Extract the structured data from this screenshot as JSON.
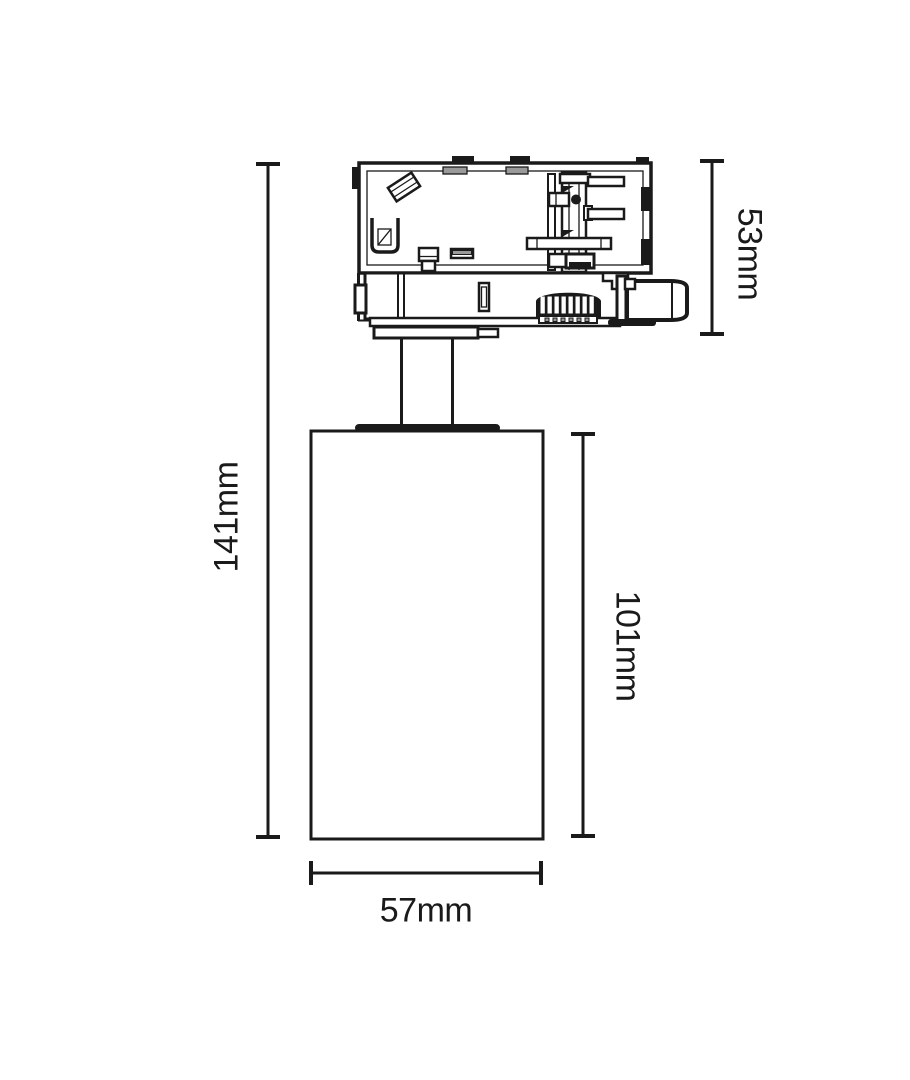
{
  "dimensions": {
    "overall_height": "141mm",
    "adapter_height": "53mm",
    "body_height": "101mm",
    "body_width": "57mm"
  },
  "colors": {
    "line": "#1a1a1a",
    "background": "#ffffff"
  }
}
